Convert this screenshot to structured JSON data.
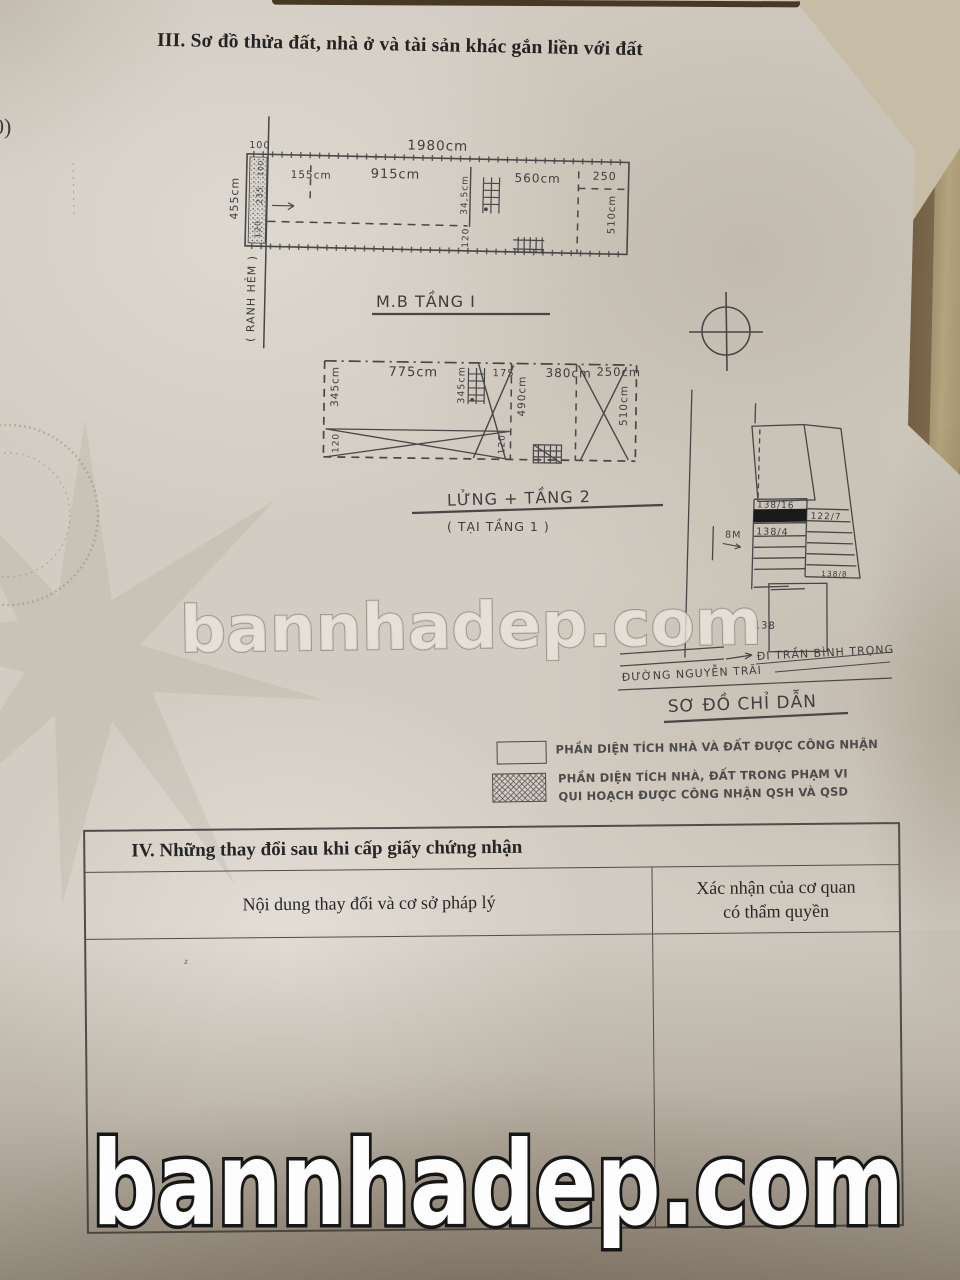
{
  "colors": {
    "paper": "#d2ccc2",
    "ink": "#474747",
    "background": "#584630",
    "watermark_fill": "#fdfdfd",
    "watermark_outline": "#161616"
  },
  "header": {
    "section_title": "III. Sơ đồ thửa đất, nhà ở và tài sản khác gắn liền với đất",
    "edge_mark": "0)"
  },
  "plan1": {
    "label": "M.B TẦNG I",
    "total_width": "1980cm",
    "offset_top": "100",
    "left_height": "455cm",
    "strip_top": "100",
    "strip_mid": "235",
    "strip_bottom": "120",
    "seg1": "155cm",
    "seg2": "915cm",
    "seg3": "560cm",
    "seg4": "250",
    "stair_dim": "34,5cm",
    "mid_bottom": "120",
    "right_height": "510cm",
    "boundary": "( RANH HẺM )"
  },
  "plan2": {
    "label": "LỬNG + TẦNG 2",
    "sublabel": "( TẠI TẦNG 1 )",
    "seg1": "775cm",
    "seg2": "175",
    "seg3": "380cm",
    "seg4": "250cm",
    "left_height": "345cm",
    "stair_height": "345cm",
    "mid_height": "490cm",
    "right_height": "510cm",
    "cell1_bottom": "120",
    "cell2_bottom": "120"
  },
  "map": {
    "title": "SƠ ĐỒ CHỈ DẪN",
    "lot_a": "138/16",
    "lot_b": "122/7",
    "lot_c": "138/4",
    "lot_d": "138/8",
    "lot_e": "138",
    "alley_width": "8M",
    "street_direction": "ĐI TRẦN BÌNH TRỌNG",
    "street_name": "ĐƯỜNG NGUYỄN TRÃI"
  },
  "legend": {
    "item1": "PHẦN DIỆN TÍCH NHÀ VÀ ĐẤT ĐƯỢC CÔNG NHẬN",
    "item2_line1": "PHẦN DIỆN TÍCH NHÀ, ĐẤT TRONG PHẠM VI",
    "item2_line2": "QUI HOẠCH ĐƯỢC CÔNG NHẬN QSH VÀ QSD"
  },
  "section4": {
    "title": "IV. Những thay đổi sau khi cấp giấy chứng nhận",
    "col1_header": "Nội dung thay đổi và cơ sở pháp lý",
    "col2_header_line1": "Xác nhận của cơ quan",
    "col2_header_line2": "có thẩm quyền",
    "cell_mark": "z"
  },
  "watermark": {
    "center": "bannhadep.com",
    "bottom": "bannhadep.com"
  }
}
